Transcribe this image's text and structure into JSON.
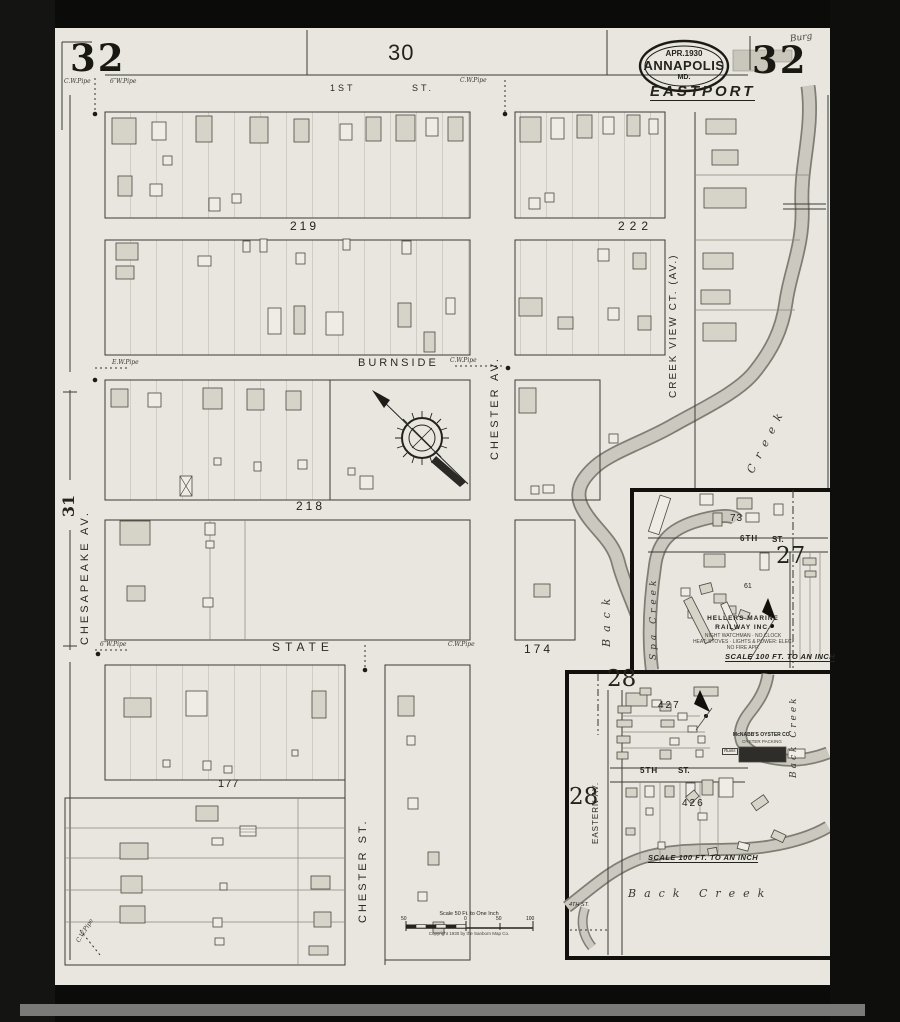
{
  "frame": {
    "sheet_number_left": "32",
    "sheet_number_right": "32",
    "adjacent_sheet_top": "30",
    "adjacent_sheet_left": "31",
    "corner_note": "Burg"
  },
  "stamp": {
    "date": "APR.1930",
    "city": "ANNAPOLIS",
    "state": "MD."
  },
  "district_label": "EASTPORT",
  "main_map": {
    "street_first": "1ST",
    "street_first_suffix": "ST.",
    "street_burnside": "BURNSIDE",
    "street_state": "STATE",
    "street_chesapeake": "CHESAPEAKE AV.",
    "street_chester_av": "CHESTER AV.",
    "street_chester_st": "CHESTER ST.",
    "street_creek_view": "CREEK VIEW CT. (AV.)",
    "block_219": "219",
    "block_222": "222",
    "block_218": "218",
    "block_174": "174",
    "block_177": "177",
    "water_back": "Back",
    "water_creek": "Creek",
    "pipe_notes": [
      "C.W.Pipe",
      "6″W.Pipe",
      "C.W.Pipe",
      "E.W.Pipe",
      "C.W.Pipe",
      "6″W.Pipe",
      "C.W.Pipe",
      "C.W.Pipe"
    ]
  },
  "inset_27": {
    "number": "27",
    "block_73": "73",
    "block_61": "61",
    "street_sixth": "6TH",
    "street_sixth_suffix": "ST.",
    "water_spa_creek": "Spa Creek",
    "business_line1": "HELLERS MARINE",
    "business_line2": "RAILWAY INC.",
    "business_fine1": "NIGHT WATCHMAN · NO CLOCK",
    "business_fine2": "HEAT: STOVES · LIGHTS & POWER: ELEC.",
    "business_fine3": "NO FIRE APP.",
    "scale_note": "SCALE 100 FT. TO AN INCH"
  },
  "inset_28": {
    "number_top": "28",
    "number_left": "28",
    "block_427": "427",
    "block_426": "426",
    "street_fifth": "5TH",
    "street_fifth_suffix": "ST.",
    "street_eastern": "EASTERN AV.",
    "street_fourth": "4TH ST.",
    "business_line1": "McNABB'S OYSTER CO.",
    "business_line2": "OYSTER PACKING",
    "ruins_label": "Ruins",
    "water_back_creek_side": "Back Creek",
    "water_back_creek_bottom": "Back  Creek",
    "scale_note": "SCALE 100 FT. TO AN INCH"
  },
  "scale_bar": {
    "title": "Scale 50 Ft. to One Inch",
    "ticks": [
      "50",
      "0",
      "50",
      "100"
    ],
    "copyright": "Copyright 1930 by the Sanborn Map Co."
  },
  "colors": {
    "paper": "#e8e6df",
    "ink": "#23221d",
    "water": "#c9c7bd"
  }
}
